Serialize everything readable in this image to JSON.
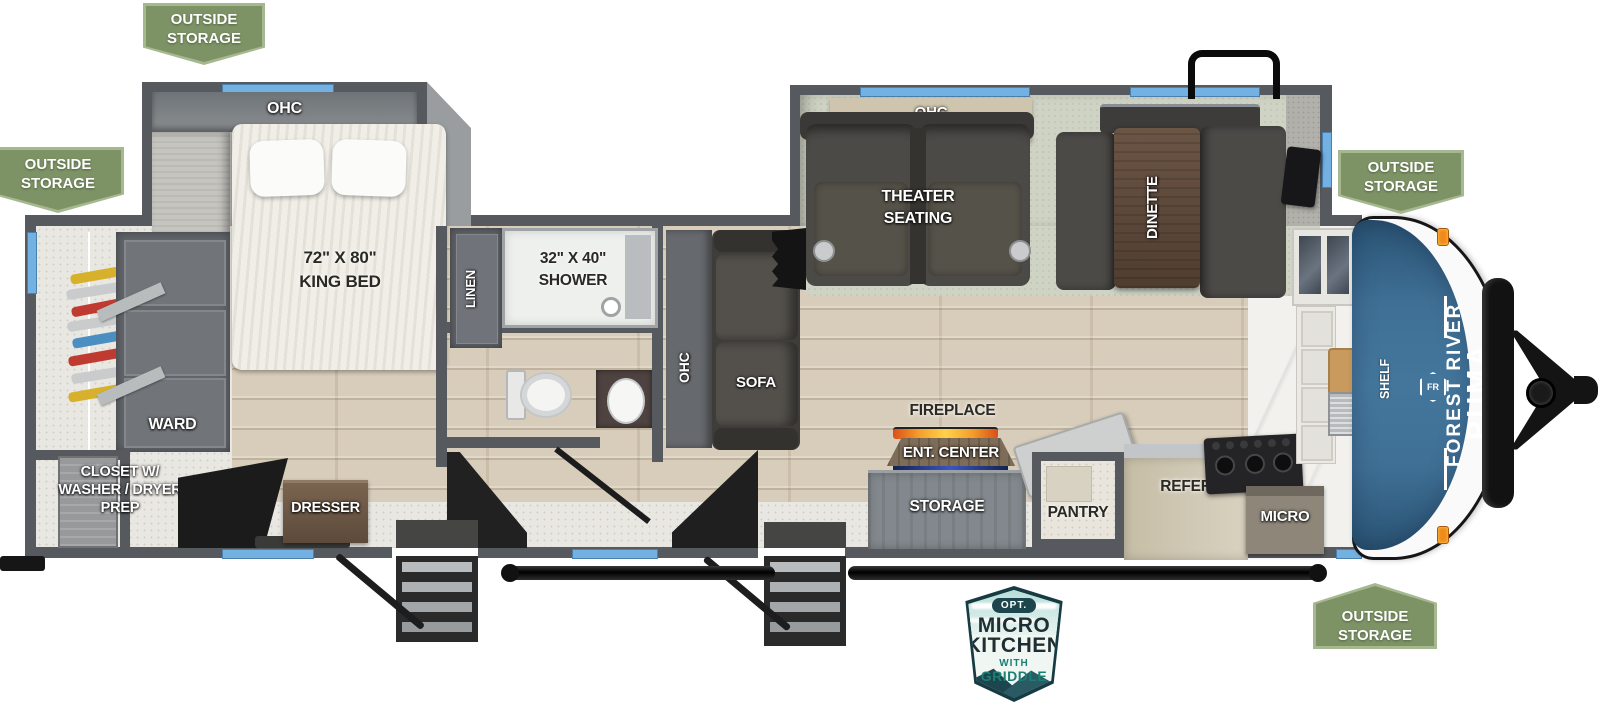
{
  "badges": {
    "outside_storage": {
      "line1": "OUTSIDE",
      "line2": "STORAGE"
    }
  },
  "option_badge": {
    "tag": "OPT.",
    "title1": "MICRO",
    "title2": "KITCHEN",
    "sub1": "WITH",
    "sub2": "GRIDDLE"
  },
  "brand": {
    "maker": "FOREST RIVER",
    "model": "PUMA",
    "logo_text": "FR"
  },
  "rooms": {
    "bedroom": {
      "ohc": "OHC",
      "bed_size": "72\" X 80\"",
      "bed_name": "KING BED",
      "ward": "WARD",
      "closet_line1": "CLOSET W/",
      "closet_line2": "WASHER / DRYER",
      "closet_line3": "PREP",
      "dresser": "DRESSER"
    },
    "bathroom": {
      "linen": "LINEN",
      "shower_size": "32\" X 40\"",
      "shower_name": "SHOWER"
    },
    "living": {
      "ohc_sofa": "OHC",
      "sofa": "SOFA",
      "ohc_slide": "OHC",
      "theater_line1": "THEATER",
      "theater_line2": "SEATING",
      "dinette": "DINETTE"
    },
    "kitchen": {
      "fireplace": "FIREPLACE",
      "ent_center": "ENT. CENTER",
      "storage": "STORAGE",
      "pantry": "PANTRY",
      "refer": "REFER",
      "micro": "MICRO",
      "shelf": "SHELF"
    }
  },
  "colors": {
    "badge_green": "#7d9365",
    "badge_border": "#a6b890",
    "wall_gray": "#565a5e",
    "window_blue": "#74b1e3",
    "cap_blue": "#3f6f95",
    "marker_orange": "#f08a1c",
    "floor_wood": "#d8cdba",
    "rug_green": "#cfd3c4",
    "option_teal_dark": "#1c454e",
    "option_teal": "#1b7f73",
    "flame_orange": "#f59f2c"
  }
}
